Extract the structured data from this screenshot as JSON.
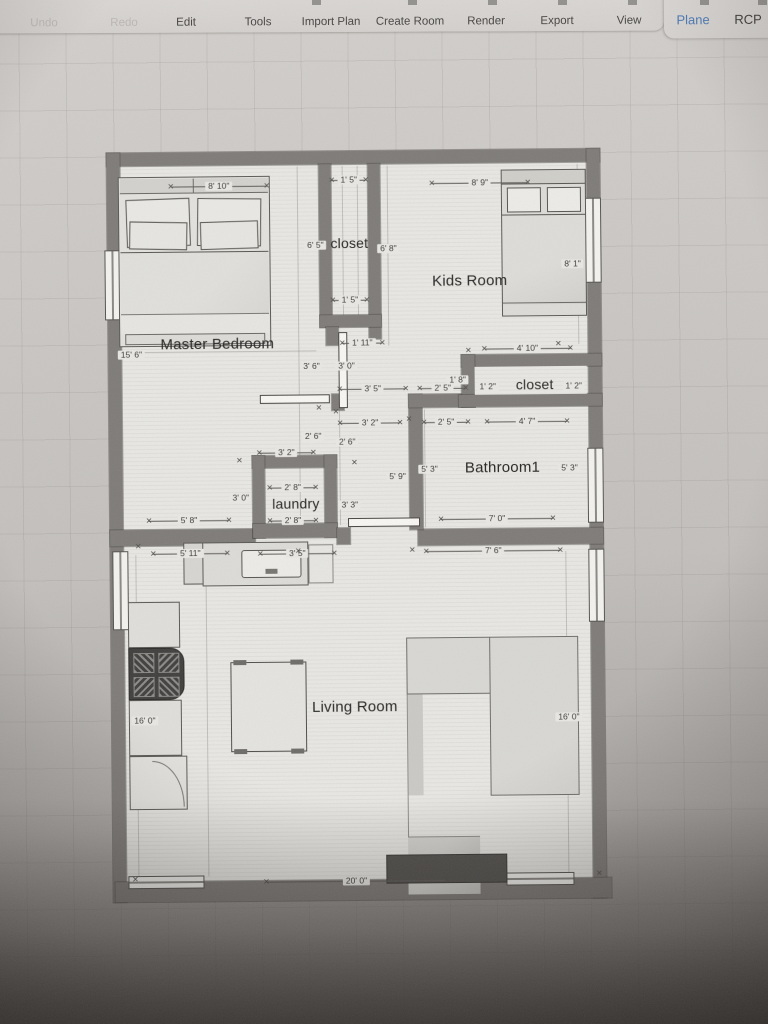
{
  "toolbar": {
    "items": [
      {
        "label": "Undo",
        "x": 44,
        "disabled": true
      },
      {
        "label": "Redo",
        "x": 124,
        "disabled": true
      },
      {
        "label": "Edit",
        "x": 186,
        "disabled": false
      },
      {
        "label": "Tools",
        "x": 258,
        "disabled": false
      },
      {
        "label": "Import Plan",
        "x": 331,
        "disabled": false
      },
      {
        "label": "Create Room",
        "x": 410,
        "disabled": false
      },
      {
        "label": "Render",
        "x": 486,
        "disabled": false
      },
      {
        "label": "Export",
        "x": 557,
        "disabled": false
      },
      {
        "label": "View",
        "x": 629,
        "disabled": false
      }
    ],
    "view_modes": [
      {
        "label": "Plane",
        "x": 693,
        "active": true
      },
      {
        "label": "RCP",
        "x": 748,
        "active": false
      }
    ],
    "accent_color": "#4c7ab6"
  },
  "icons": {
    "dimension_tick": "✕"
  },
  "floorplan": {
    "room_labels": [
      {
        "text": "Master Bedroom",
        "x": 219,
        "y": 343,
        "size": 15
      },
      {
        "text": "closet",
        "x": 352,
        "y": 243,
        "size": 14
      },
      {
        "text": "Kids Room",
        "x": 472,
        "y": 282,
        "size": 15
      },
      {
        "text": "closet",
        "x": 536,
        "y": 386,
        "size": 14
      },
      {
        "text": "Bathroom1",
        "x": 503,
        "y": 469,
        "size": 15
      },
      {
        "text": "laundry",
        "x": 296,
        "y": 503,
        "size": 14
      },
      {
        "text": "Living Room",
        "x": 353,
        "y": 707,
        "size": 15
      }
    ],
    "dimensions": [
      {
        "t": "8' 10\"",
        "x": 222,
        "y": 185,
        "dir": "h",
        "len": 96
      },
      {
        "t": "1' 5\"",
        "x": 352,
        "y": 180,
        "dir": "h",
        "len": 34
      },
      {
        "t": "8' 9\"",
        "x": 483,
        "y": 184,
        "dir": "h",
        "len": 96
      },
      {
        "t": "6' 5\"",
        "x": 318,
        "y": 245
      },
      {
        "t": "6' 8\"",
        "x": 391,
        "y": 249
      },
      {
        "t": "8' 1\"",
        "x": 575,
        "y": 266
      },
      {
        "t": "1' 5\"",
        "x": 352,
        "y": 300,
        "dir": "h",
        "len": 34
      },
      {
        "t": "15' 6\"",
        "x": 133,
        "y": 353
      },
      {
        "t": "1' 11\"",
        "x": 364,
        "y": 343,
        "dir": "h",
        "len": 40
      },
      {
        "t": "4' 10\"",
        "x": 529,
        "y": 350,
        "dir": "h",
        "len": 86
      },
      {
        "t": "3' 6\"",
        "x": 313,
        "y": 366
      },
      {
        "t": "3' 0\"",
        "x": 348,
        "y": 366
      },
      {
        "t": "3' 5\"",
        "x": 374,
        "y": 389,
        "dir": "h",
        "len": 66
      },
      {
        "t": "2' 5\"",
        "x": 444,
        "y": 389,
        "dir": "h",
        "len": 46
      },
      {
        "t": "1' 8\"",
        "x": 459,
        "y": 381
      },
      {
        "t": "1' 2\"",
        "x": 489,
        "y": 388
      },
      {
        "t": "1' 2\"",
        "x": 575,
        "y": 388
      },
      {
        "t": "3' 2\"",
        "x": 371,
        "y": 423,
        "dir": "h",
        "len": 60
      },
      {
        "t": "2' 5\"",
        "x": 447,
        "y": 423,
        "dir": "h",
        "len": 44
      },
      {
        "t": "4' 7\"",
        "x": 528,
        "y": 423,
        "dir": "h",
        "len": 80
      },
      {
        "t": "2' 6\"",
        "x": 314,
        "y": 436
      },
      {
        "t": "2' 6\"",
        "x": 348,
        "y": 442
      },
      {
        "t": "3' 2\"",
        "x": 287,
        "y": 452,
        "dir": "h",
        "len": 54
      },
      {
        "t": "5' 9\"",
        "x": 398,
        "y": 477
      },
      {
        "t": "5' 3\"",
        "x": 430,
        "y": 470
      },
      {
        "t": "5' 3\"",
        "x": 570,
        "y": 470
      },
      {
        "t": "2' 8\"",
        "x": 293,
        "y": 487,
        "dir": "h",
        "len": 46
      },
      {
        "t": "3' 0\"",
        "x": 241,
        "y": 497
      },
      {
        "t": "3' 3\"",
        "x": 350,
        "y": 505
      },
      {
        "t": "2' 8\"",
        "x": 293,
        "y": 520,
        "dir": "h",
        "len": 46
      },
      {
        "t": "5' 8\"",
        "x": 189,
        "y": 519,
        "dir": "h",
        "len": 80
      },
      {
        "t": "7' 0\"",
        "x": 497,
        "y": 520,
        "dir": "h",
        "len": 112
      },
      {
        "t": "5' 11\"",
        "x": 190,
        "y": 552,
        "dir": "h",
        "len": 74
      },
      {
        "t": "3' 5\"",
        "x": 297,
        "y": 553,
        "dir": "h",
        "len": 74
      },
      {
        "t": "7' 6\"",
        "x": 493,
        "y": 552,
        "dir": "h",
        "len": 134
      },
      {
        "t": "16' 0\"",
        "x": 143,
        "y": 719
      },
      {
        "t": "16' 0\"",
        "x": 567,
        "y": 719
      },
      {
        "t": "20' 0\"",
        "x": 353,
        "y": 881,
        "dir": "h",
        "len": 180
      }
    ],
    "furniture": [
      "master-bed",
      "kids-bed",
      "kitchen-counter",
      "stove",
      "refrigerator",
      "sink-counter",
      "dining-table",
      "sectional-sofa",
      "tv-console"
    ],
    "colors": {
      "wall": "#7e7b78",
      "floor": "#e8e7e3",
      "line": "#55534f"
    }
  }
}
